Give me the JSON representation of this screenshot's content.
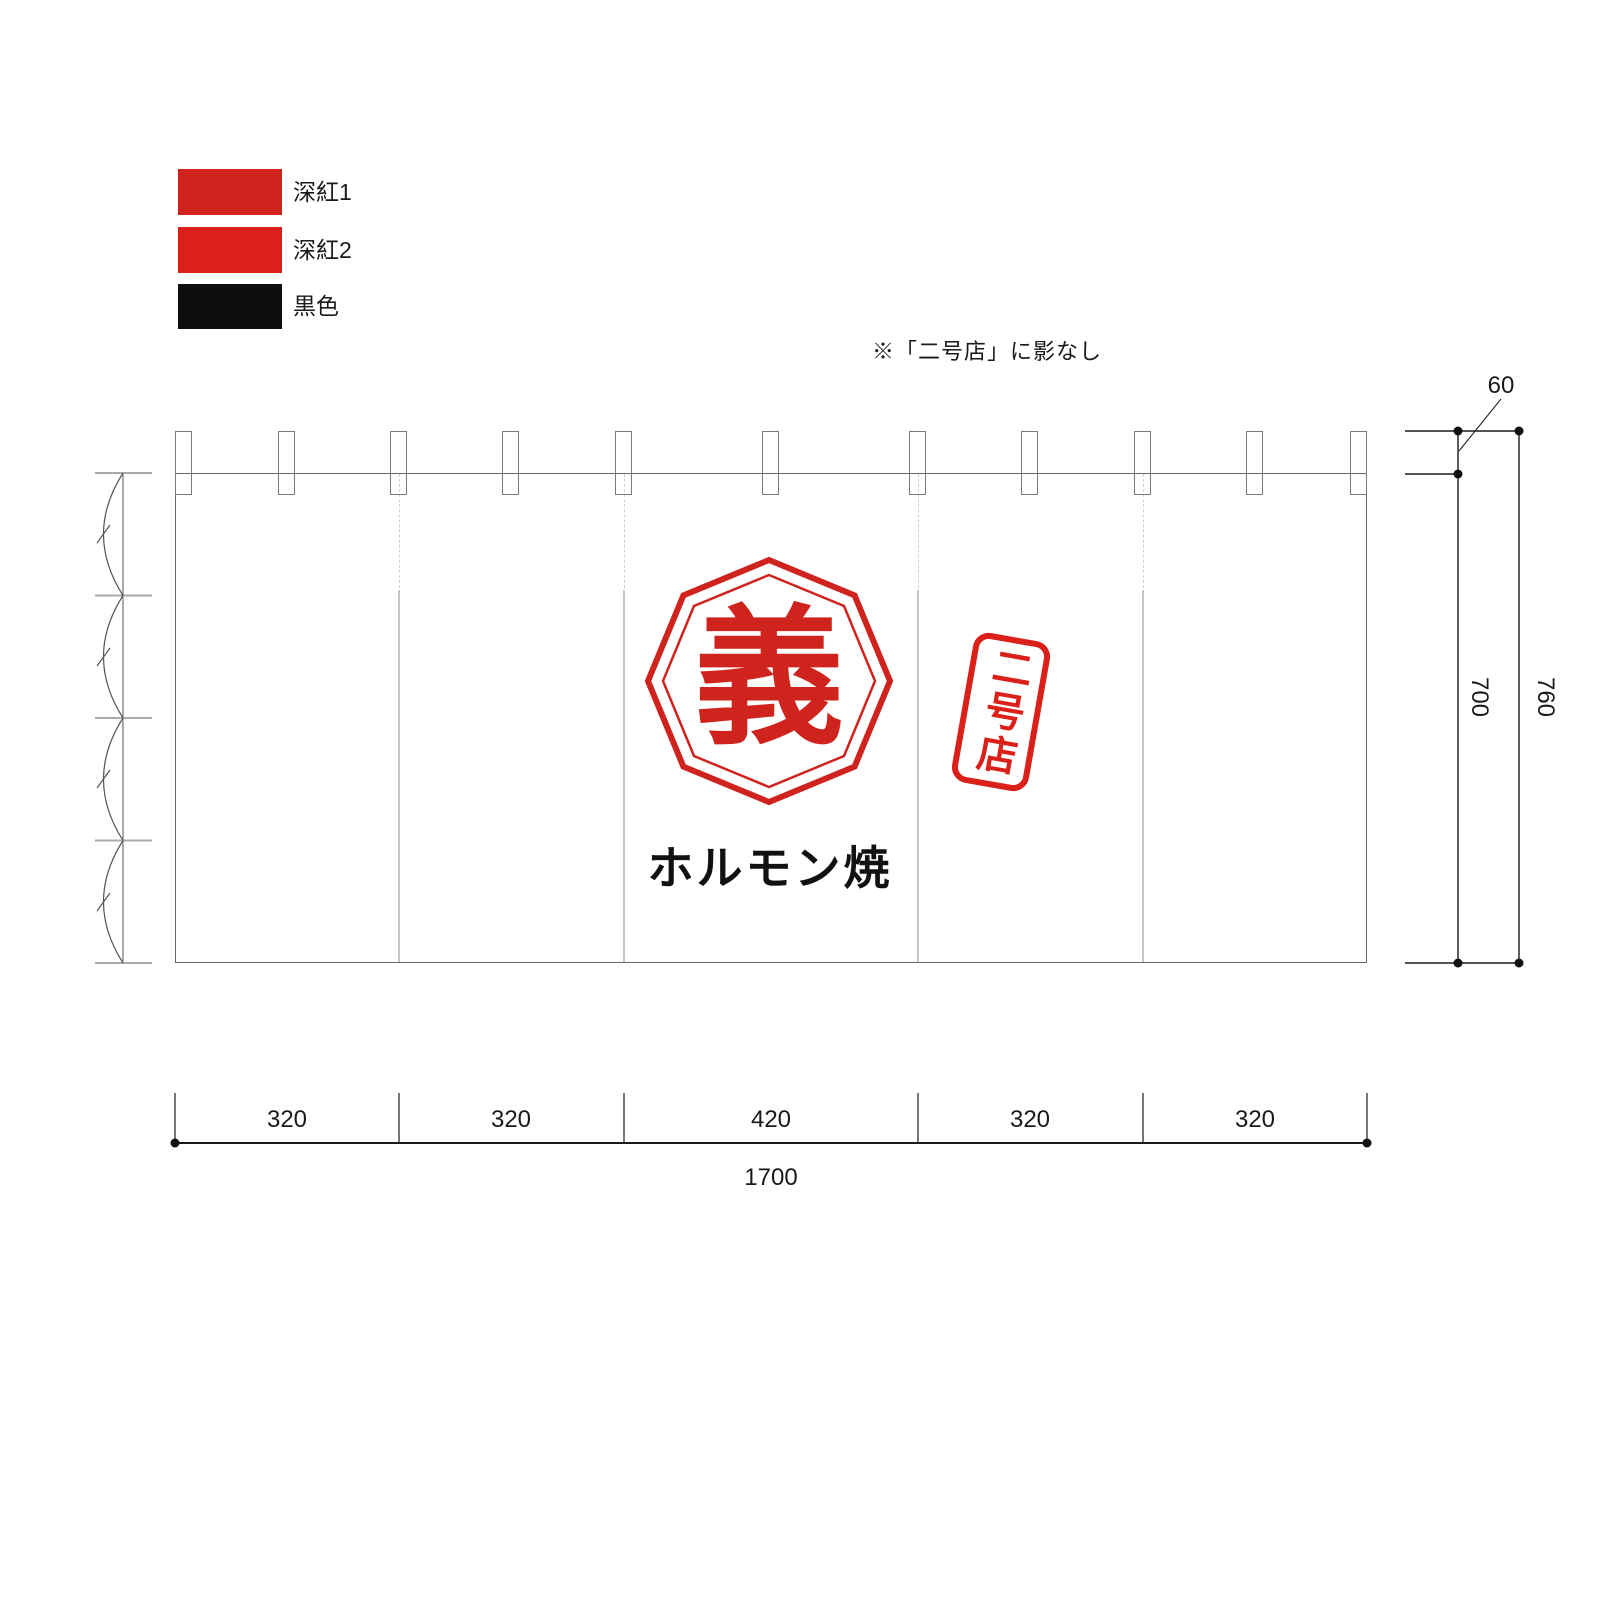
{
  "legend": {
    "items": [
      {
        "label": "深紅1",
        "color": "#cf241e"
      },
      {
        "label": "深紅2",
        "color": "#db1f19"
      },
      {
        "label": "黒色",
        "color": "#0f0d0d"
      }
    ]
  },
  "note": "※「二号店」に影なし",
  "curtain": {
    "logo_char": "義",
    "stamp_text": "二号店",
    "bottom_text": "ホルモン焼",
    "tab_count": 11,
    "panel_count": 5
  },
  "dimensions": {
    "tab_offset": "60",
    "curtain_height": "700",
    "total_height": "760",
    "panel_widths": [
      "320",
      "320",
      "420",
      "320",
      "320"
    ],
    "total_width": "1700"
  },
  "colors": {
    "red1": "#cf241e",
    "red2": "#db1f19",
    "black": "#0f0d0d",
    "line": "#1a1a1a"
  }
}
